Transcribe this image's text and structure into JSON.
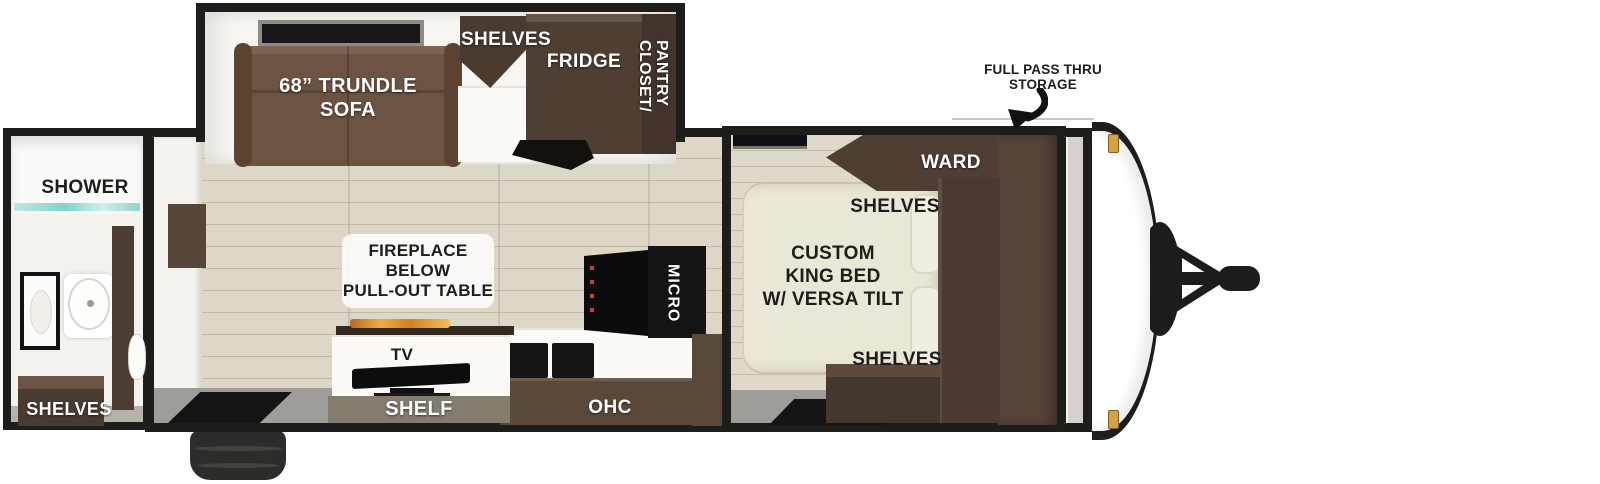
{
  "diagram_type": "travel trailer floor plan",
  "exterior": {
    "full_pass_thru_line1": "FULL PASS THRU",
    "full_pass_thru_line2": "STORAGE"
  },
  "bathroom": {
    "shower_label": "SHOWER",
    "shelves_label": "SHELVES"
  },
  "living_area": {
    "sofa_label_line1": "68” TRUNDLE",
    "sofa_label_line2": "SOFA",
    "shelves_label": "SHELVES",
    "fridge_label": "FRIDGE",
    "closet_pantry_label": "CLOSET/\nPANTRY",
    "fireplace_line1": "FIREPLACE",
    "fireplace_line2": "BELOW",
    "fireplace_line3": "PULL-OUT TABLE",
    "tv_label": "TV",
    "shelf_label": "SHELF",
    "ohc_label": "OHC",
    "micro_label": "MICRO"
  },
  "bedroom": {
    "ward_label": "WARD",
    "shelves_top_label": "SHELVES",
    "bed_line1": "CUSTOM",
    "bed_line2": "KING BED",
    "bed_line3": "W/ VERSA TILT",
    "shelves_bottom_label": "SHELVES"
  },
  "colors": {
    "wall": "#1d1d1b",
    "floor": "#dcd7c7",
    "sofa": "#6d5341",
    "cabinet_dark": "#4a3a30",
    "cabinet_mid": "#5a4839",
    "bed": "#ebe7d8",
    "lower_wall": "#9e9d97",
    "marker_light": "#d7a13b",
    "flame": "#e89636",
    "shower_glass": "#7fd4c9"
  }
}
